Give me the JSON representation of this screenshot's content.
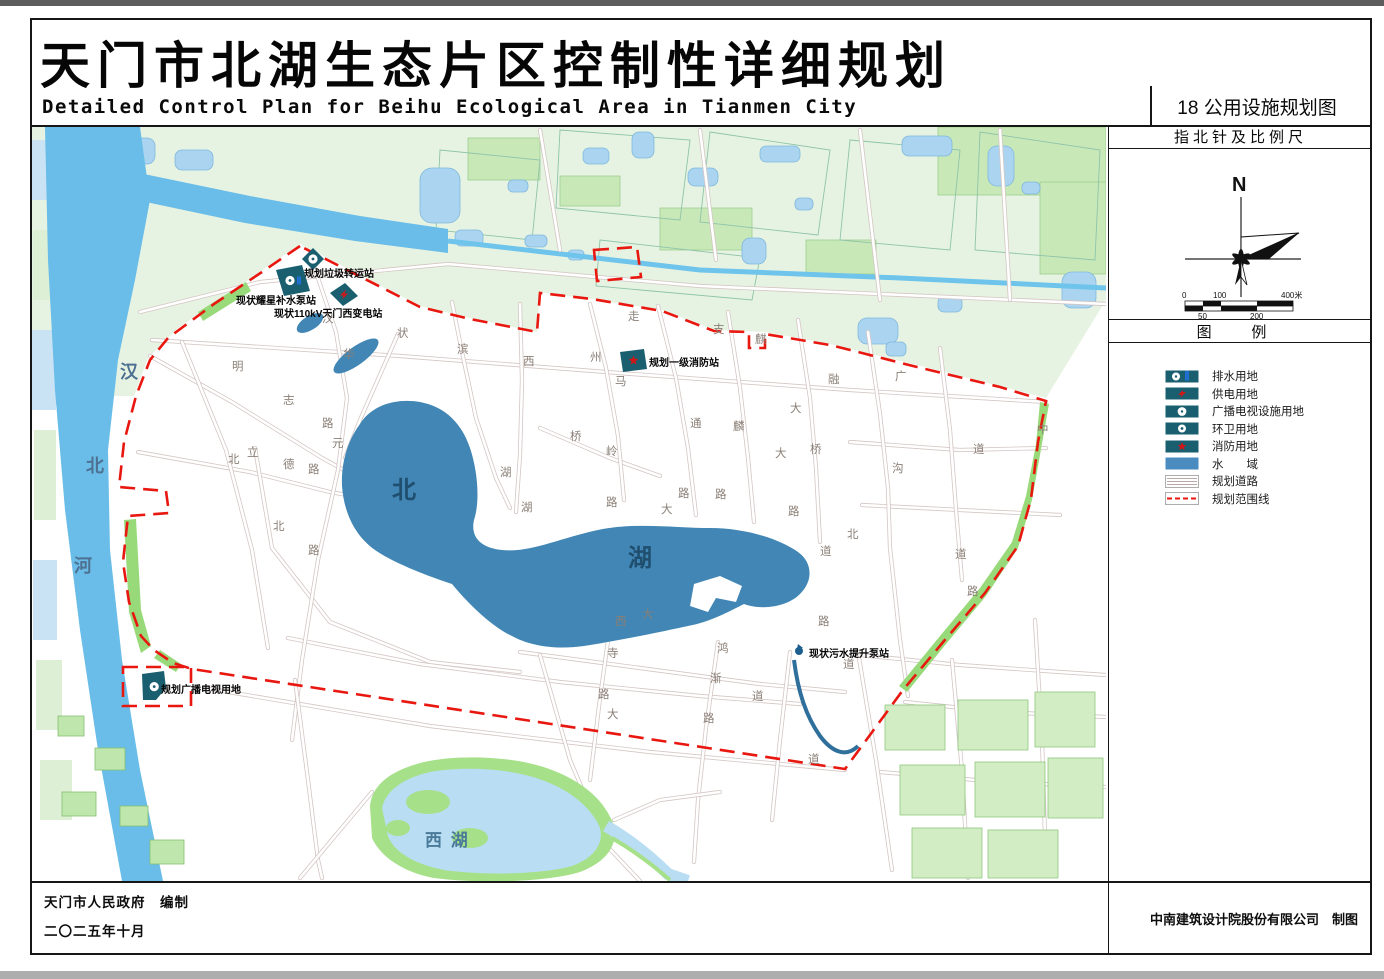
{
  "title": {
    "cn": "天门市北湖生态片区控制性详细规划",
    "en": "Detailed Control Plan for Beihu Ecological Area in Tianmen City",
    "map_no": "18 公用设施规划图"
  },
  "panel": {
    "north_header": "指北针及比例尺",
    "north_letter": "N",
    "scale_ticks_top": [
      "0",
      "100",
      "400米"
    ],
    "scale_ticks_bottom": [
      "50",
      "200"
    ],
    "legend_header": "图    例",
    "legend": [
      {
        "label": "排水用地",
        "icon": "drain"
      },
      {
        "label": "供电用地",
        "icon": "power"
      },
      {
        "label": "广播电视设施用地",
        "icon": "broadcast"
      },
      {
        "label": "环卫用地",
        "icon": "sanitation"
      },
      {
        "label": "消防用地",
        "icon": "fire"
      },
      {
        "label": "水　　域",
        "icon": "water"
      },
      {
        "label": "规划道路",
        "icon": "road"
      },
      {
        "label": "规划范围线",
        "icon": "boundary"
      }
    ]
  },
  "footer": {
    "left_line1": "天门市人民政府　编制",
    "left_line2": "二〇二五年十月",
    "right": "中南建筑设计院股份有限公司　制图"
  },
  "map": {
    "facilities": [
      {
        "label": "规划垃圾转运站",
        "lx": 304,
        "ly": 277,
        "type": "sanitation",
        "pts": "302,259 313,248 324,259 313,270"
      },
      {
        "label": "现状耀星补水泵站",
        "lx": 236,
        "ly": 304,
        "type": "drain",
        "pts": "276,270 302,265 310,291 284,296"
      },
      {
        "label": "现状110kV天门西变电站",
        "lx": 274,
        "ly": 317,
        "type": "power",
        "pts": "330,293 345,283 358,296 343,306"
      },
      {
        "label": "规划一级消防站",
        "lx": 649,
        "ly": 366,
        "type": "fire",
        "pts": "620,352 644,349 647,369 623,372"
      },
      {
        "label": "现状污水提升泵站",
        "lx": 809,
        "ly": 657,
        "type": "sewage",
        "pts": ""
      },
      {
        "label": "规划广播电视用地",
        "lx": 161,
        "ly": 693,
        "type": "broadcast",
        "pts": "142,674 164,671 166,688 156,700 143,700"
      }
    ],
    "water_labels": [
      {
        "t": "汉",
        "x": 120,
        "y": 378,
        "s": 18,
        "c": "#4e7192"
      },
      {
        "t": "北",
        "x": 86,
        "y": 472,
        "s": 18,
        "c": "#4e7192"
      },
      {
        "t": "河",
        "x": 74,
        "y": 572,
        "s": 18,
        "c": "#4e7192"
      },
      {
        "t": "北",
        "x": 392,
        "y": 498,
        "s": 24,
        "c": "#1f4e6e"
      },
      {
        "t": "湖",
        "x": 628,
        "y": 566,
        "s": 24,
        "c": "#1f4e6e"
      },
      {
        "t": "西  湖",
        "x": 425,
        "y": 846,
        "s": 17,
        "c": "#4a7a9a"
      }
    ],
    "road_chars": [
      {
        "t": "明",
        "x": 232,
        "y": 370
      },
      {
        "t": "志",
        "x": 283,
        "y": 404
      },
      {
        "t": "路",
        "x": 322,
        "y": 427
      },
      {
        "t": "汉",
        "x": 322,
        "y": 322
      },
      {
        "t": "华",
        "x": 343,
        "y": 358
      },
      {
        "t": "元",
        "x": 332,
        "y": 447
      },
      {
        "t": "路",
        "x": 308,
        "y": 473
      },
      {
        "t": "立",
        "x": 247,
        "y": 456
      },
      {
        "t": "德",
        "x": 283,
        "y": 468
      },
      {
        "t": "北",
        "x": 228,
        "y": 463
      },
      {
        "t": "北",
        "x": 273,
        "y": 530
      },
      {
        "t": "路",
        "x": 308,
        "y": 554
      },
      {
        "t": "状",
        "x": 397,
        "y": 337
      },
      {
        "t": "滨",
        "x": 457,
        "y": 353
      },
      {
        "t": "湖",
        "x": 500,
        "y": 476
      },
      {
        "t": "西",
        "x": 523,
        "y": 365
      },
      {
        "t": "湖",
        "x": 521,
        "y": 511
      },
      {
        "t": "州",
        "x": 590,
        "y": 361
      },
      {
        "t": "马",
        "x": 615,
        "y": 385
      },
      {
        "t": "走",
        "x": 628,
        "y": 320
      },
      {
        "t": "支",
        "x": 713,
        "y": 333
      },
      {
        "t": "麒",
        "x": 755,
        "y": 343
      },
      {
        "t": "融",
        "x": 828,
        "y": 383
      },
      {
        "t": "广",
        "x": 895,
        "y": 380
      },
      {
        "t": "沟",
        "x": 892,
        "y": 472
      },
      {
        "t": "通",
        "x": 690,
        "y": 427
      },
      {
        "t": "麟",
        "x": 733,
        "y": 430
      },
      {
        "t": "桥",
        "x": 570,
        "y": 440
      },
      {
        "t": "岭",
        "x": 606,
        "y": 455
      },
      {
        "t": "路",
        "x": 606,
        "y": 506
      },
      {
        "t": "大",
        "x": 790,
        "y": 412
      },
      {
        "t": "桥",
        "x": 810,
        "y": 453
      },
      {
        "t": "大",
        "x": 775,
        "y": 457
      },
      {
        "t": "路",
        "x": 678,
        "y": 497
      },
      {
        "t": "路",
        "x": 715,
        "y": 498
      },
      {
        "t": "路",
        "x": 788,
        "y": 515
      },
      {
        "t": "大",
        "x": 661,
        "y": 513
      },
      {
        "t": "北",
        "x": 847,
        "y": 538
      },
      {
        "t": "道",
        "x": 820,
        "y": 555
      },
      {
        "t": "路",
        "x": 818,
        "y": 625
      },
      {
        "t": "道",
        "x": 843,
        "y": 668
      },
      {
        "t": "西",
        "x": 615,
        "y": 625
      },
      {
        "t": "寺",
        "x": 607,
        "y": 657
      },
      {
        "t": "路",
        "x": 598,
        "y": 698
      },
      {
        "t": "大",
        "x": 642,
        "y": 618
      },
      {
        "t": "鸿",
        "x": 717,
        "y": 652
      },
      {
        "t": "渐",
        "x": 710,
        "y": 682
      },
      {
        "t": "路",
        "x": 703,
        "y": 722
      },
      {
        "t": "道",
        "x": 752,
        "y": 700
      },
      {
        "t": "道",
        "x": 973,
        "y": 453
      },
      {
        "t": "道",
        "x": 955,
        "y": 558
      },
      {
        "t": "路",
        "x": 967,
        "y": 595
      },
      {
        "t": "中",
        "x": 1037,
        "y": 433
      },
      {
        "t": "大",
        "x": 607,
        "y": 718
      },
      {
        "t": "道",
        "x": 808,
        "y": 763
      }
    ]
  },
  "colors": {
    "teal": "#1a5f70",
    "boundary_red": "#e8170f",
    "lake_blue": "#4186b4",
    "river_blue": "#69bde8",
    "pale_water": "#b9ddf2",
    "pale_green": "#e7f3e2",
    "mid_green": "#c9e8b8",
    "strip_green": "#98da79",
    "road_edge": "#d4c6c4",
    "road_char": "#8a7f76",
    "marker_red": "#cf1717",
    "marker_blue": "#1f6fd0"
  }
}
